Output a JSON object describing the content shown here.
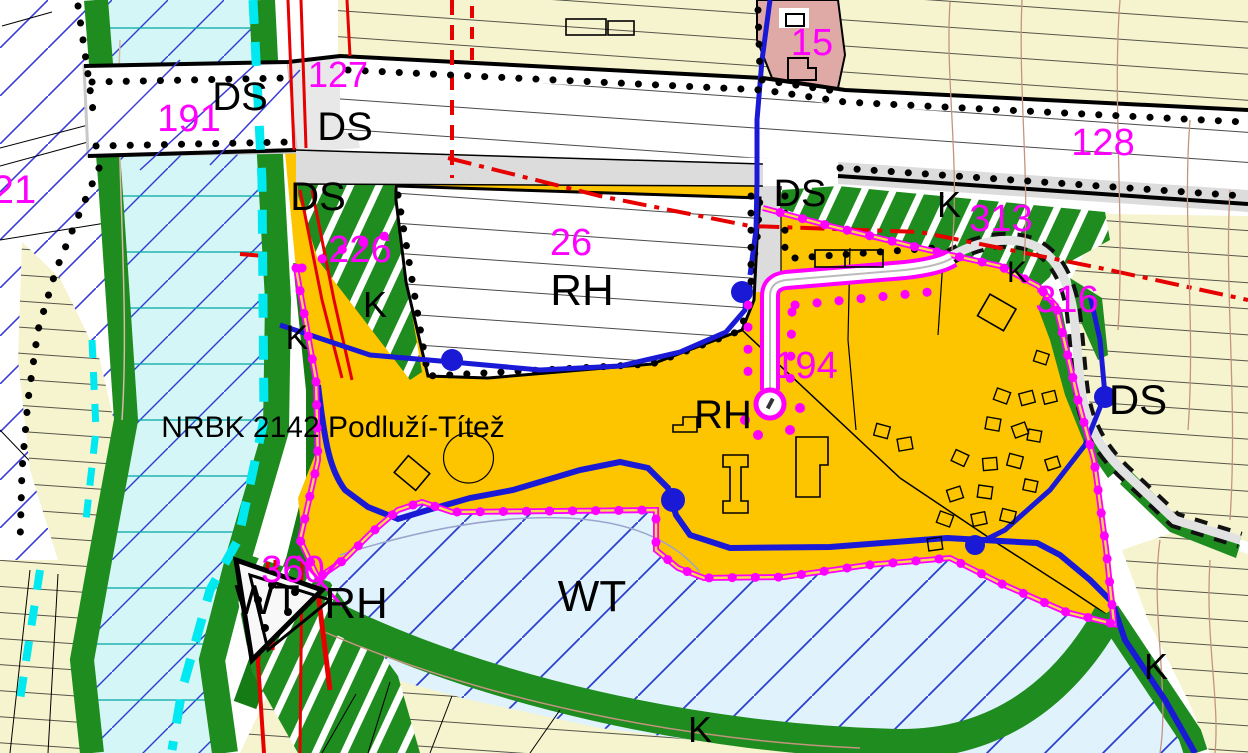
{
  "map": {
    "canvas": {
      "width": 1248,
      "height": 753
    },
    "corridor_annotation": "NRBK 2142 Podluží-Títež",
    "colors": {
      "recreation_zone_yellow": "#FDC500",
      "field_pale_yellow": "#F6F4CE",
      "watercourse_cyan_fill": "#D5F6F6",
      "water_body_fill": "#E0F2FC",
      "greenery": "#1E8C1E",
      "housing_pink": "#DFA9A5",
      "boundary_magenta": "#FF00FF",
      "utility_red": "#E60000",
      "stream_blue": "#1A1AD6",
      "flood_dash_cyan": "#00E8F0",
      "road_gray": "#DCDCDC",
      "contour_brown": "#C49480"
    },
    "labels": [
      {
        "id": "nrbk-corridor",
        "text": "NRBK 2142 Podluží-Títež",
        "x": 333,
        "y": 428,
        "size": 30,
        "color": "#000"
      },
      {
        "id": "zone-ds-1",
        "text": "DS",
        "x": 240,
        "y": 97,
        "size": 40,
        "color": "#000"
      },
      {
        "id": "zone-ds-2",
        "text": "DS",
        "x": 345,
        "y": 127,
        "size": 40,
        "color": "#000"
      },
      {
        "id": "zone-ds-3",
        "text": "DS",
        "x": 318,
        "y": 197,
        "size": 40,
        "color": "#000"
      },
      {
        "id": "zone-ds-4",
        "text": "DS",
        "x": 800,
        "y": 194,
        "size": 38,
        "color": "#000"
      },
      {
        "id": "zone-ds-5",
        "text": "DS",
        "x": 1138,
        "y": 400,
        "size": 42,
        "color": "#000"
      },
      {
        "id": "zone-rh-1",
        "text": "RH",
        "x": 582,
        "y": 291,
        "size": 44,
        "color": "#000"
      },
      {
        "id": "zone-rh-2",
        "text": "RH",
        "x": 723,
        "y": 415,
        "size": 40,
        "color": "#000"
      },
      {
        "id": "zone-rh-3",
        "text": "RH",
        "x": 356,
        "y": 604,
        "size": 44,
        "color": "#000"
      },
      {
        "id": "zone-wt-1",
        "text": "WT",
        "x": 592,
        "y": 597,
        "size": 44,
        "color": "#000"
      },
      {
        "id": "zone-wt-2",
        "text": "WT",
        "x": 267,
        "y": 600,
        "size": 42,
        "color": "#000"
      },
      {
        "id": "zone-k-1",
        "text": "K",
        "x": 375,
        "y": 305,
        "size": 36,
        "color": "#000"
      },
      {
        "id": "zone-k-2",
        "text": "K",
        "x": 297,
        "y": 338,
        "size": 34,
        "color": "#000"
      },
      {
        "id": "zone-k-3",
        "text": "K",
        "x": 949,
        "y": 205,
        "size": 36,
        "color": "#000"
      },
      {
        "id": "zone-k-4",
        "text": "K",
        "x": 1017,
        "y": 273,
        "size": 30,
        "color": "#000"
      },
      {
        "id": "zone-k-5",
        "text": "K",
        "x": 700,
        "y": 730,
        "size": 36,
        "color": "#000"
      },
      {
        "id": "zone-k-6",
        "text": "K",
        "x": 1156,
        "y": 667,
        "size": 36,
        "color": "#000"
      },
      {
        "id": "parcel-21",
        "text": "21",
        "x": 14,
        "y": 190,
        "size": 40,
        "color": "#FF00FF"
      },
      {
        "id": "parcel-191",
        "text": "191",
        "x": 189,
        "y": 119,
        "size": 38,
        "color": "#FF00FF"
      },
      {
        "id": "parcel-127",
        "text": "127",
        "x": 338,
        "y": 75,
        "size": 36,
        "color": "#FF00FF"
      },
      {
        "id": "parcel-226",
        "text": "226",
        "x": 360,
        "y": 250,
        "size": 38,
        "color": "#FF00FF"
      },
      {
        "id": "parcel-26",
        "text": "26",
        "x": 571,
        "y": 243,
        "size": 38,
        "color": "#FF00FF"
      },
      {
        "id": "parcel-128",
        "text": "128",
        "x": 1103,
        "y": 143,
        "size": 38,
        "color": "#FF00FF"
      },
      {
        "id": "parcel-15",
        "text": "15",
        "x": 812,
        "y": 43,
        "size": 38,
        "color": "#FF00FF"
      },
      {
        "id": "parcel-313",
        "text": "313",
        "x": 1001,
        "y": 219,
        "size": 38,
        "color": "#FF00FF"
      },
      {
        "id": "parcel-316",
        "text": "316",
        "x": 1067,
        "y": 300,
        "size": 38,
        "color": "#FF00FF"
      },
      {
        "id": "parcel-194",
        "text": "194",
        "x": 806,
        "y": 366,
        "size": 38,
        "color": "#FF00FF"
      },
      {
        "id": "parcel-360",
        "text": "360",
        "x": 293,
        "y": 570,
        "size": 38,
        "color": "#FF00FF"
      }
    ]
  }
}
